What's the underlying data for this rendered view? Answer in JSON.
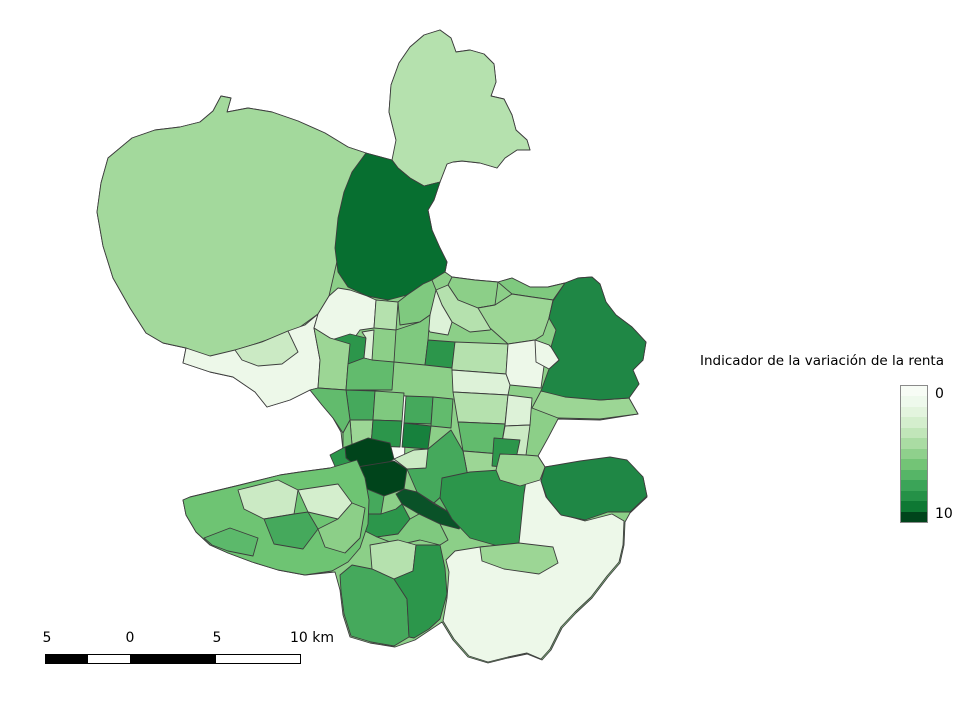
{
  "window": {
    "background": "#ffffff"
  },
  "legend": {
    "title": "Indicador de la variación de la renta",
    "top_tick": "0",
    "bottom_tick": "10",
    "colors": [
      "#f7fcf5",
      "#eef9ec",
      "#e3f4de",
      "#d4eecd",
      "#c1e6b9",
      "#aadca3",
      "#8fd08c",
      "#73c476",
      "#56b567",
      "#3ba458",
      "#259147",
      "#0e7833",
      "#00441b"
    ]
  },
  "scalebar": {
    "labels": [
      "5",
      "0",
      "5",
      "10 km"
    ],
    "segment_colors": [
      "#000000",
      "#ffffff",
      "#000000",
      "#ffffff"
    ]
  },
  "map": {
    "stroke": "#3d3d3d",
    "regions": [
      {
        "id": "base",
        "fill": "#8ccf88"
      },
      {
        "id": "elpardo",
        "fill": "#a3d99c"
      },
      {
        "id": "northcap",
        "fill": "#b5e1ae"
      },
      {
        "id": "darknorth",
        "fill": "#076f30"
      },
      {
        "id": "valverde_w",
        "fill": "#8ccf88"
      },
      {
        "id": "valverde_s",
        "fill": "#b5e1ae"
      },
      {
        "id": "valdefuentes",
        "fill": "#ddf2d8"
      },
      {
        "id": "sanchinarro",
        "fill": "#7fc97f"
      },
      {
        "id": "hortaleza",
        "fill": "#9cd695"
      },
      {
        "id": "aravaca_pale",
        "fill": "#edf8e9"
      },
      {
        "id": "aravaca_mid",
        "fill": "#cbeac4"
      },
      {
        "id": "mirasierra",
        "fill": "#edf8e9"
      },
      {
        "id": "pilar",
        "fill": "#2c964b"
      },
      {
        "id": "penagrande",
        "fill": "#ddf2d8"
      },
      {
        "id": "pale_right",
        "fill": "#b5e1ae"
      },
      {
        "id": "fuencarral_s",
        "fill": "#7fc97f"
      },
      {
        "id": "tetuan_w",
        "fill": "#9cd695"
      },
      {
        "id": "tetuan_row",
        "fill": "#62bb6d"
      },
      {
        "id": "chamartin_1",
        "fill": "#7fc97f"
      },
      {
        "id": "chamartin_dark",
        "fill": "#2c964b"
      },
      {
        "id": "prosperidad",
        "fill": "#b5e1ae"
      },
      {
        "id": "pale_band_1",
        "fill": "#edf8e9"
      },
      {
        "id": "pale_band_2",
        "fill": "#ddf2d8"
      },
      {
        "id": "clineal_1",
        "fill": "#b5e1ae"
      },
      {
        "id": "clineal_2",
        "fill": "#62bb6d"
      },
      {
        "id": "clineal_3",
        "fill": "#9cd695"
      },
      {
        "id": "sanblas_pale",
        "fill": "#ddf2d8"
      },
      {
        "id": "sanblas_2",
        "fill": "#cbeac4"
      },
      {
        "id": "simancas",
        "fill": "#2c964b"
      },
      {
        "id": "castellana",
        "fill": "#f7fcf5"
      },
      {
        "id": "tetuan_c1",
        "fill": "#45a95c"
      },
      {
        "id": "tetuan_c2",
        "fill": "#7fc97f"
      },
      {
        "id": "tetuan_c3",
        "fill": "#9cd695"
      },
      {
        "id": "tetuan_c4",
        "fill": "#2c964b"
      },
      {
        "id": "chamberi_1",
        "fill": "#45a95c"
      },
      {
        "id": "salamanca_1",
        "fill": "#62bb6d"
      },
      {
        "id": "chamberi_2",
        "fill": "#17813d"
      },
      {
        "id": "moncloa",
        "fill": "#62bb6d"
      },
      {
        "id": "arguelles",
        "fill": "#7fc97f"
      },
      {
        "id": "center_dark1",
        "fill": "#00441b"
      },
      {
        "id": "center_dark2",
        "fill": "#00441b"
      },
      {
        "id": "center_diag",
        "fill": "#0a5228"
      },
      {
        "id": "center_w1",
        "fill": "#2c964b"
      },
      {
        "id": "center_w2",
        "fill": "#17813d"
      },
      {
        "id": "center_s1",
        "fill": "#45a95c"
      },
      {
        "id": "center_s2",
        "fill": "#2c964b"
      },
      {
        "id": "salamanca_2",
        "fill": "#45a95c"
      },
      {
        "id": "justicia",
        "fill": "#cbeac4"
      },
      {
        "id": "retiro",
        "fill": "#62bb6d"
      },
      {
        "id": "arganzuela",
        "fill": "#7fc97f"
      },
      {
        "id": "usera",
        "fill": "#b5e1ae"
      },
      {
        "id": "villaverde_w",
        "fill": "#45a95c"
      },
      {
        "id": "villaverde_e",
        "fill": "#2c964b"
      },
      {
        "id": "vallecas_dark",
        "fill": "#2c964b"
      },
      {
        "id": "vicalvaro_pale",
        "fill": "#edf8e9"
      },
      {
        "id": "vallecas_band",
        "fill": "#9cd695"
      },
      {
        "id": "moratalaz",
        "fill": "#9cd695"
      },
      {
        "id": "canaveral",
        "fill": "#1f8745"
      },
      {
        "id": "canillejas",
        "fill": "#9cd695"
      },
      {
        "id": "barajas",
        "fill": "#1f8745"
      },
      {
        "id": "barajas_notch",
        "fill": "#edf8e9"
      },
      {
        "id": "latina_bg",
        "fill": "#6ec473"
      },
      {
        "id": "latina_pale",
        "fill": "#d4eecd"
      },
      {
        "id": "latina_1",
        "fill": "#cbeac4"
      },
      {
        "id": "latina_2",
        "fill": "#5cb96b"
      },
      {
        "id": "carabanchel_1",
        "fill": "#45a95c"
      },
      {
        "id": "carabanchel_2",
        "fill": "#8ccf88"
      }
    ]
  }
}
